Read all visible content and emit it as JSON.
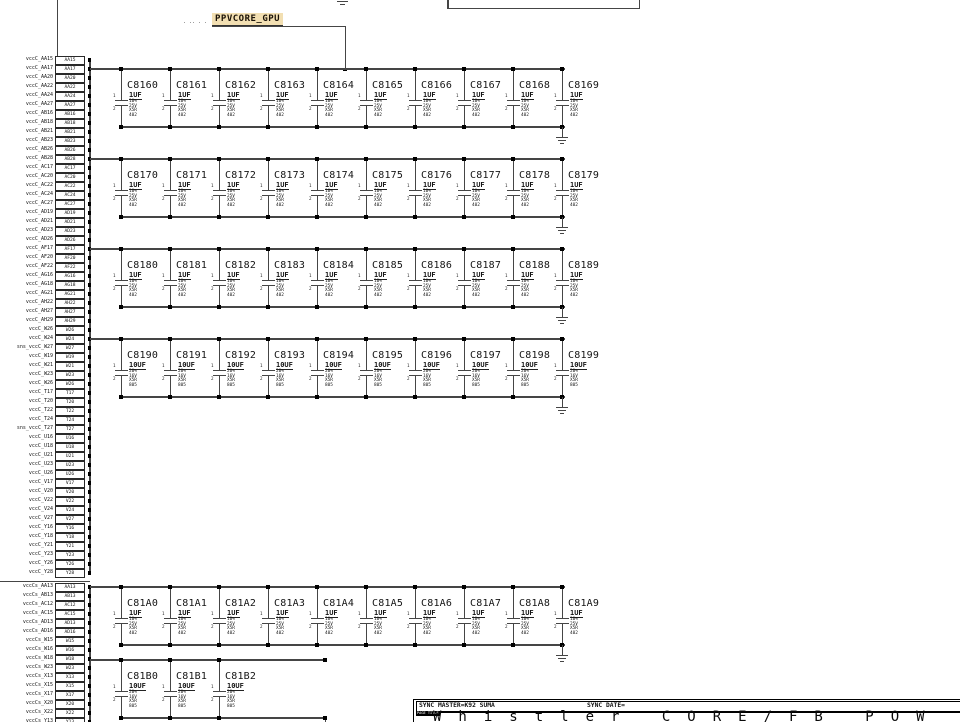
{
  "schematic": {
    "net_label": "PPVCORE_GPU",
    "ref_marks": ". .. . .",
    "cap_pin_numbers": [
      "1",
      "2"
    ],
    "pin_groups": [
      {
        "name": "vccc-core-pins",
        "rows": [
          {
            "n": "vccC_AA15",
            "p": "AA15"
          },
          {
            "n": "vccC_AA17",
            "p": "AA17"
          },
          {
            "n": "vccC_AA20",
            "p": "AA20"
          },
          {
            "n": "vccC_AA22",
            "p": "AA22"
          },
          {
            "n": "vccC_AA24",
            "p": "AA24"
          },
          {
            "n": "vccC_AA27",
            "p": "AA27"
          },
          {
            "n": "vccC_AB16",
            "p": "AB16"
          },
          {
            "n": "vccC_AB18",
            "p": "AB18"
          },
          {
            "n": "vccC_AB21",
            "p": "AB21"
          },
          {
            "n": "vccC_AB23",
            "p": "AB23"
          },
          {
            "n": "vccC_AB26",
            "p": "AB26"
          },
          {
            "n": "vccC_AB28",
            "p": "AB28"
          },
          {
            "n": "vccC_AC17",
            "p": "AC17"
          },
          {
            "n": "vccC_AC20",
            "p": "AC20"
          },
          {
            "n": "vccC_AC22",
            "p": "AC22"
          },
          {
            "n": "vccC_AC24",
            "p": "AC24"
          },
          {
            "n": "vccC_AC27",
            "p": "AC27"
          },
          {
            "n": "vccC_AD19",
            "p": "AD19"
          },
          {
            "n": "vccC_AD21",
            "p": "AD21"
          },
          {
            "n": "vccC_AD23",
            "p": "AD23"
          },
          {
            "n": "vccC_AD26",
            "p": "AD26"
          },
          {
            "n": "vccC_AF17",
            "p": "AF17"
          },
          {
            "n": "vccC_AF20",
            "p": "AF20"
          },
          {
            "n": "vccC_AF22",
            "p": "AF22"
          },
          {
            "n": "vccC_AG16",
            "p": "AG16"
          },
          {
            "n": "vccC_AG18",
            "p": "AG18"
          },
          {
            "n": "vccC_AG21",
            "p": "AG21"
          },
          {
            "n": "vccC_AH22",
            "p": "AH22"
          },
          {
            "n": "vccC_AH27",
            "p": "AH27"
          },
          {
            "n": "vccC_AH29",
            "p": "AH29"
          },
          {
            "n": "vccC_W26",
            "p": "W26"
          },
          {
            "n": "vccC_W24",
            "p": "W24"
          },
          {
            "n": "sns_vccC_W27",
            "p": "W27"
          },
          {
            "n": "vccC_W19",
            "p": "W19"
          },
          {
            "n": "vccC_W21",
            "p": "W21"
          },
          {
            "n": "vccC_W23",
            "p": "W23"
          },
          {
            "n": "vccC_W26",
            "p": "W26"
          },
          {
            "n": "vccC_T17",
            "p": "T17"
          },
          {
            "n": "vccC_T20",
            "p": "T20"
          },
          {
            "n": "vccC_T22",
            "p": "T22"
          },
          {
            "n": "vccC_T24",
            "p": "T24"
          },
          {
            "n": "sns_vccC_T27",
            "p": "T27"
          },
          {
            "n": "vccC_U16",
            "p": "U16"
          },
          {
            "n": "vccC_U18",
            "p": "U18"
          },
          {
            "n": "vccC_U21",
            "p": "U21"
          },
          {
            "n": "vccC_U23",
            "p": "U23"
          },
          {
            "n": "vccC_U26",
            "p": "U26"
          },
          {
            "n": "vccC_V17",
            "p": "V17"
          },
          {
            "n": "vccC_V20",
            "p": "V20"
          },
          {
            "n": "vccC_V22",
            "p": "V22"
          },
          {
            "n": "vccC_V24",
            "p": "V24"
          },
          {
            "n": "vccC_V27",
            "p": "V27"
          },
          {
            "n": "vccC_Y16",
            "p": "Y16"
          },
          {
            "n": "vccC_Y18",
            "p": "Y18"
          },
          {
            "n": "vccC_Y21",
            "p": "Y21"
          },
          {
            "n": "vccC_Y23",
            "p": "Y23"
          },
          {
            "n": "vccC_Y26",
            "p": "Y26"
          },
          {
            "n": "vccC_Y28",
            "p": "Y28"
          }
        ]
      },
      {
        "name": "vcccs-fb-pins",
        "rows": [
          {
            "n": "vccCs_AA13",
            "p": "AA13"
          },
          {
            "n": "vccCs_AB13",
            "p": "AB13"
          },
          {
            "n": "vccCs_AC12",
            "p": "AC12"
          },
          {
            "n": "vccCs_AC15",
            "p": "AC15"
          },
          {
            "n": "vccCs_AD13",
            "p": "AD13"
          },
          {
            "n": "vccCs_AD16",
            "p": "AD16"
          },
          {
            "n": "vccCs_W15",
            "p": "W15"
          },
          {
            "n": "vccCs_W16",
            "p": "W16"
          },
          {
            "n": "vccCs_W18",
            "p": "W18"
          },
          {
            "n": "vccCs_W23",
            "p": "W23"
          },
          {
            "n": "vccCs_X13",
            "p": "X13"
          },
          {
            "n": "vccCs_X15",
            "p": "X15"
          },
          {
            "n": "vccCs_X17",
            "p": "X17"
          },
          {
            "n": "vccCs_X20",
            "p": "X20"
          },
          {
            "n": "vccCs_X22",
            "p": "X22"
          },
          {
            "n": "vccCs_Y13",
            "p": "Y13"
          }
        ]
      }
    ],
    "cap_rows": [
      {
        "refs": [
          "C8160",
          "C8161",
          "C8162",
          "C8163",
          "C8164",
          "C8165",
          "C8166",
          "C8167",
          "C8168",
          "C8169"
        ],
        "value": "1UF",
        "specs": [
          "10%",
          "25V",
          "X5R",
          "402"
        ]
      },
      {
        "refs": [
          "C8170",
          "C8171",
          "C8172",
          "C8173",
          "C8174",
          "C8175",
          "C8176",
          "C8177",
          "C8178",
          "C8179"
        ],
        "value": "1UF",
        "specs": [
          "10%",
          "25V",
          "X5R",
          "402"
        ]
      },
      {
        "refs": [
          "C8180",
          "C8181",
          "C8182",
          "C8183",
          "C8184",
          "C8185",
          "C8186",
          "C8187",
          "C8188",
          "C8189"
        ],
        "value": "1UF",
        "specs": [
          "10%",
          "25V",
          "X5R",
          "402"
        ]
      },
      {
        "refs": [
          "C8190",
          "C8191",
          "C8192",
          "C8193",
          "C8194",
          "C8195",
          "C8196",
          "C8197",
          "C8198",
          "C8199"
        ],
        "value": "10UF",
        "specs": [
          "20%",
          "16V",
          "X5R",
          "805"
        ]
      },
      {
        "refs": [
          "C81A0",
          "C81A1",
          "C81A2",
          "C81A3",
          "C81A4",
          "C81A5",
          "C81A6",
          "C81A7",
          "C81A8",
          "C81A9"
        ],
        "value": "1UF",
        "specs": [
          "10%",
          "25V",
          "X5R",
          "402"
        ]
      },
      {
        "refs": [
          "C81B0",
          "C81B1",
          "C81B2"
        ],
        "value": "10UF",
        "specs": [
          "20%",
          "16V",
          "X5R",
          "805"
        ]
      }
    ],
    "title_block": {
      "sync_master": "SYNC MASTER=K92 SUMA",
      "sync_date": "SYNC DATE=",
      "page_title_label": "PAGE TITLE",
      "page_title": "Whistler CORE/FB POW"
    },
    "colors": {
      "highlight": "#f2dfb2",
      "wire": "#454545",
      "ink": "#111111",
      "background": "#ffffff"
    }
  }
}
